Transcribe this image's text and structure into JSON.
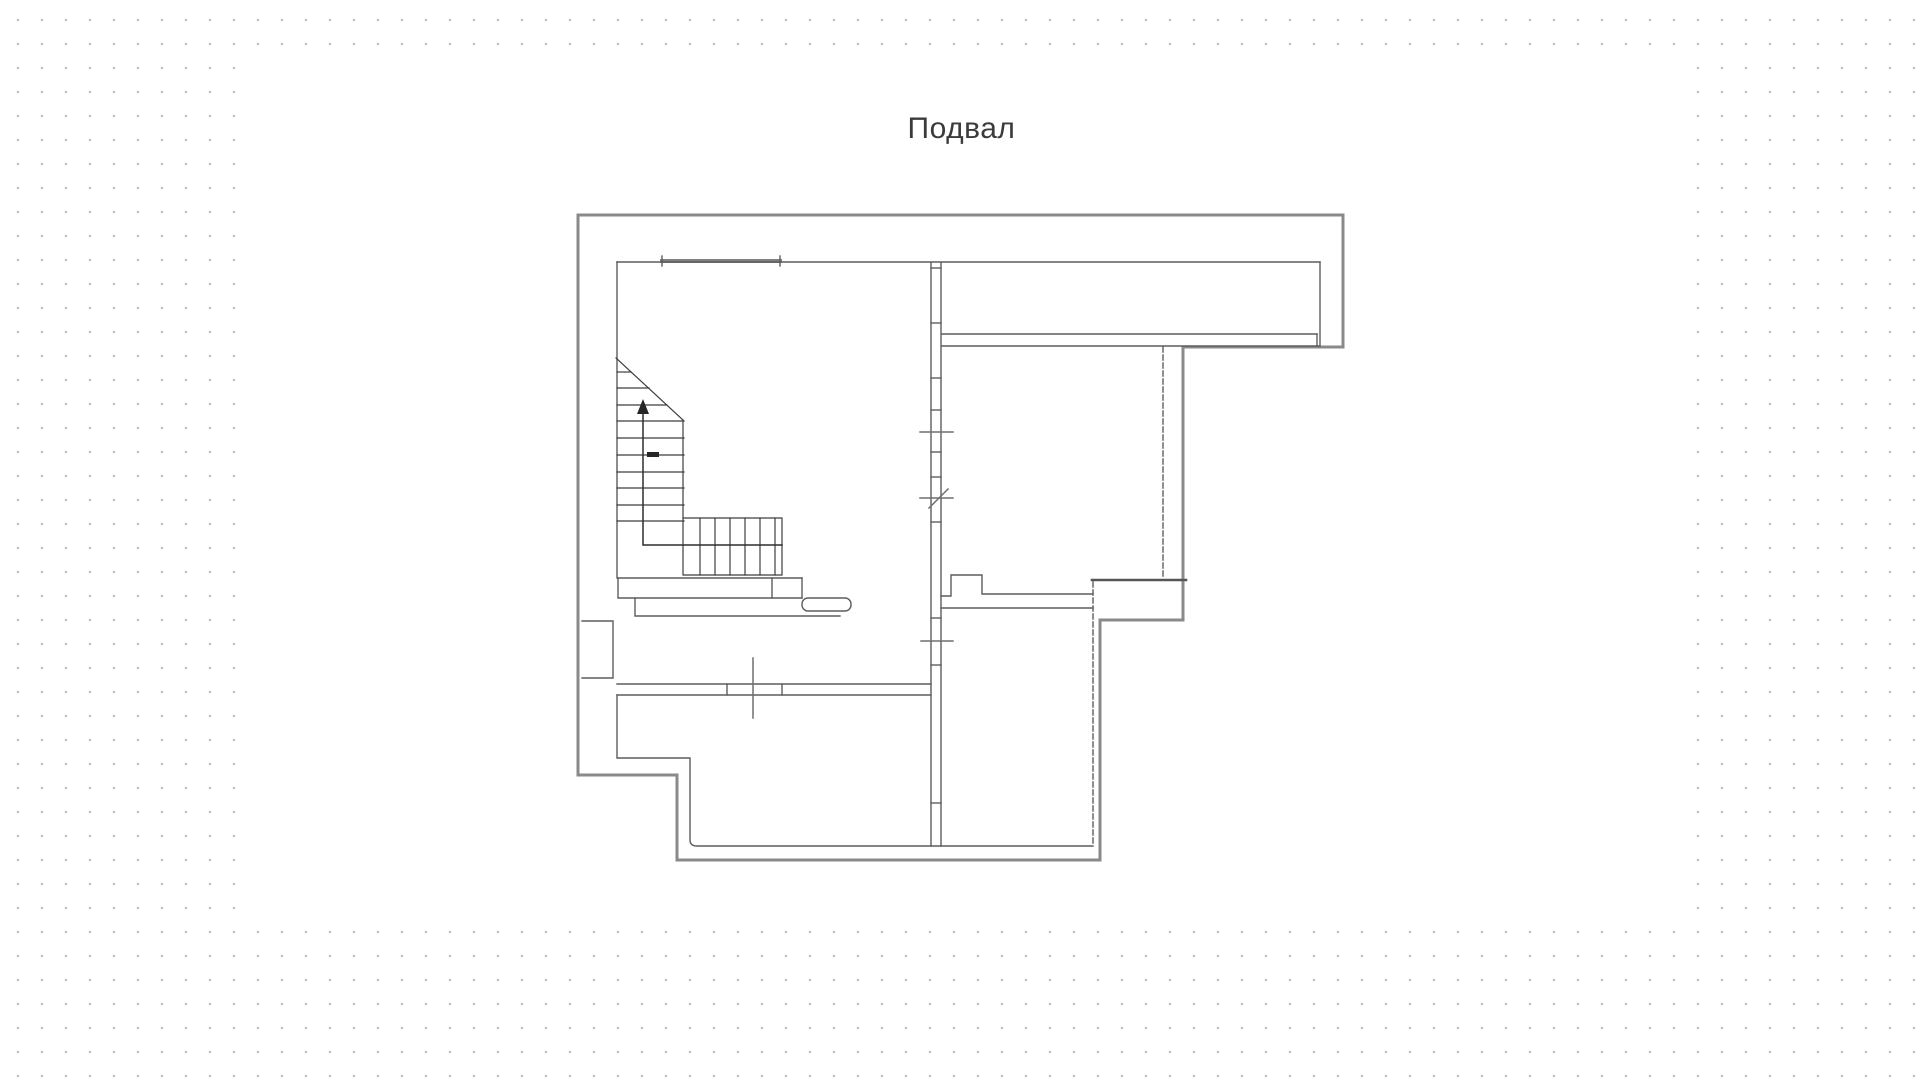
{
  "title": {
    "text": "Подвал"
  },
  "colors": {
    "dots": "#bdbdbd",
    "panel": "#ffffff",
    "title": "#3b3b3b",
    "outer_wall": "#8a8a8a",
    "inner_wall": "#5d5d5d",
    "stair_line": "#3e3e3e",
    "marker": "#6f6f6f",
    "arrow_fill": "#262626"
  },
  "plan": {
    "viewbox": "0 0 1920 1078",
    "layers": [
      {
        "name": "outer-walls",
        "stroke": "#8a8a8a",
        "width": 3,
        "paths": [
          "M578,215 L1343,215 L1343,347 L1183,347 L1183,620 L1100,620 L1100,860 L677,860 L677,775 L578,775 Z"
        ]
      },
      {
        "name": "thick-interior-wall",
        "stroke": "#565656",
        "width": 2.6,
        "paths": [
          "M1092,580 L1186,580"
        ]
      },
      {
        "name": "window-lintel",
        "stroke": "#808080",
        "width": 4,
        "paths": [
          "M662,261 L780,261"
        ]
      },
      {
        "name": "inner-walls",
        "stroke": "#5d5d5d",
        "width": 1.4,
        "paths": [
          "M617,262 L1320,262",
          "M617,262 L617,578",
          "M1320,262 L1320,346",
          "M942,334 L1317,334",
          "M942,346 L1320,346",
          "M1317,334 L1317,346",
          "M931,263 L931,846",
          "M941,263 L941,846",
          "M931,268 L941,268",
          "M931,323 L941,323",
          "M931,378 L941,378",
          "M931,410 L941,410",
          "M931,452 L941,452",
          "M931,477 L941,477",
          "M931,522 L941,522",
          "M931,618 L941,618",
          "M931,665 L941,665",
          "M931,803 L941,803",
          "M941,596 L951,596 L951,575 L982,575 L982,594 L1093,594",
          "M941,608 L1093,608",
          "M618,578 L802,578",
          "M618,578 L618,598 L635,598 L635,616 L840,616",
          "M635,598 L802,598",
          "M772,578 L772,598",
          "M802,578 L802,598",
          "M662,256 L662,266",
          "M780,256 L780,266",
          "M582,621 L613,621 L613,678 L582,678",
          "M617,684 L931,684",
          "M617,695 L931,695",
          "M727,684 L727,695",
          "M782,684 L782,695",
          "M617,695 L617,758 L690,758 L690,840 Q690,846 697,846 L1093,846"
        ],
        "rects": [
          {
            "x": 802,
            "y": 598,
            "w": 49,
            "h": 13,
            "rx": 6
          }
        ]
      },
      {
        "name": "dashed-walls",
        "stroke": "#5d5d5d",
        "width": 1.4,
        "dash": "5,3",
        "paths": [
          "M1163,347 L1163,578",
          "M1093,582 L1093,843"
        ]
      },
      {
        "name": "staircase",
        "stroke": "#3e3e3e",
        "width": 1.2,
        "paths": [
          "M616,358 L683,420",
          "M683,420 L683,518",
          "M617,372 L631,372",
          "M617,388 L649,388",
          "M617,405 L667,405",
          "M617,421 L684,421",
          "M617,438 L684,438",
          "M617,455 L684,455",
          "M617,472 L684,472",
          "M617,488 L684,488",
          "M617,505 L684,505",
          "M617,521 L684,521",
          "M683,518 L782,518 L782,575 L683,575 L683,518",
          "M700,518 L700,575",
          "M715,518 L715,575",
          "M730,518 L730,575",
          "M745,518 L745,575",
          "M760,518 L760,575",
          "M775,518 L775,575"
        ]
      },
      {
        "name": "stair-walking-line",
        "stroke": "#2e2e2e",
        "width": 1.5,
        "paths": [
          "M782,545 L643,545 L643,410"
        ]
      },
      {
        "name": "markers",
        "stroke": "#6f6f6f",
        "width": 1.5,
        "paths": [
          "M753,658 L753,718",
          "M920,432 L953,432",
          "M920,498 L953,498",
          "M921,641 L953,641",
          "M929,508 L948,489"
        ]
      },
      {
        "name": "stair-arrow-fills",
        "fill": "#262626",
        "paths": [
          "M643,399 L637,414 L649,414 Z",
          "M647,452 L659,452 L659,457 L647,457 Z"
        ]
      }
    ]
  }
}
